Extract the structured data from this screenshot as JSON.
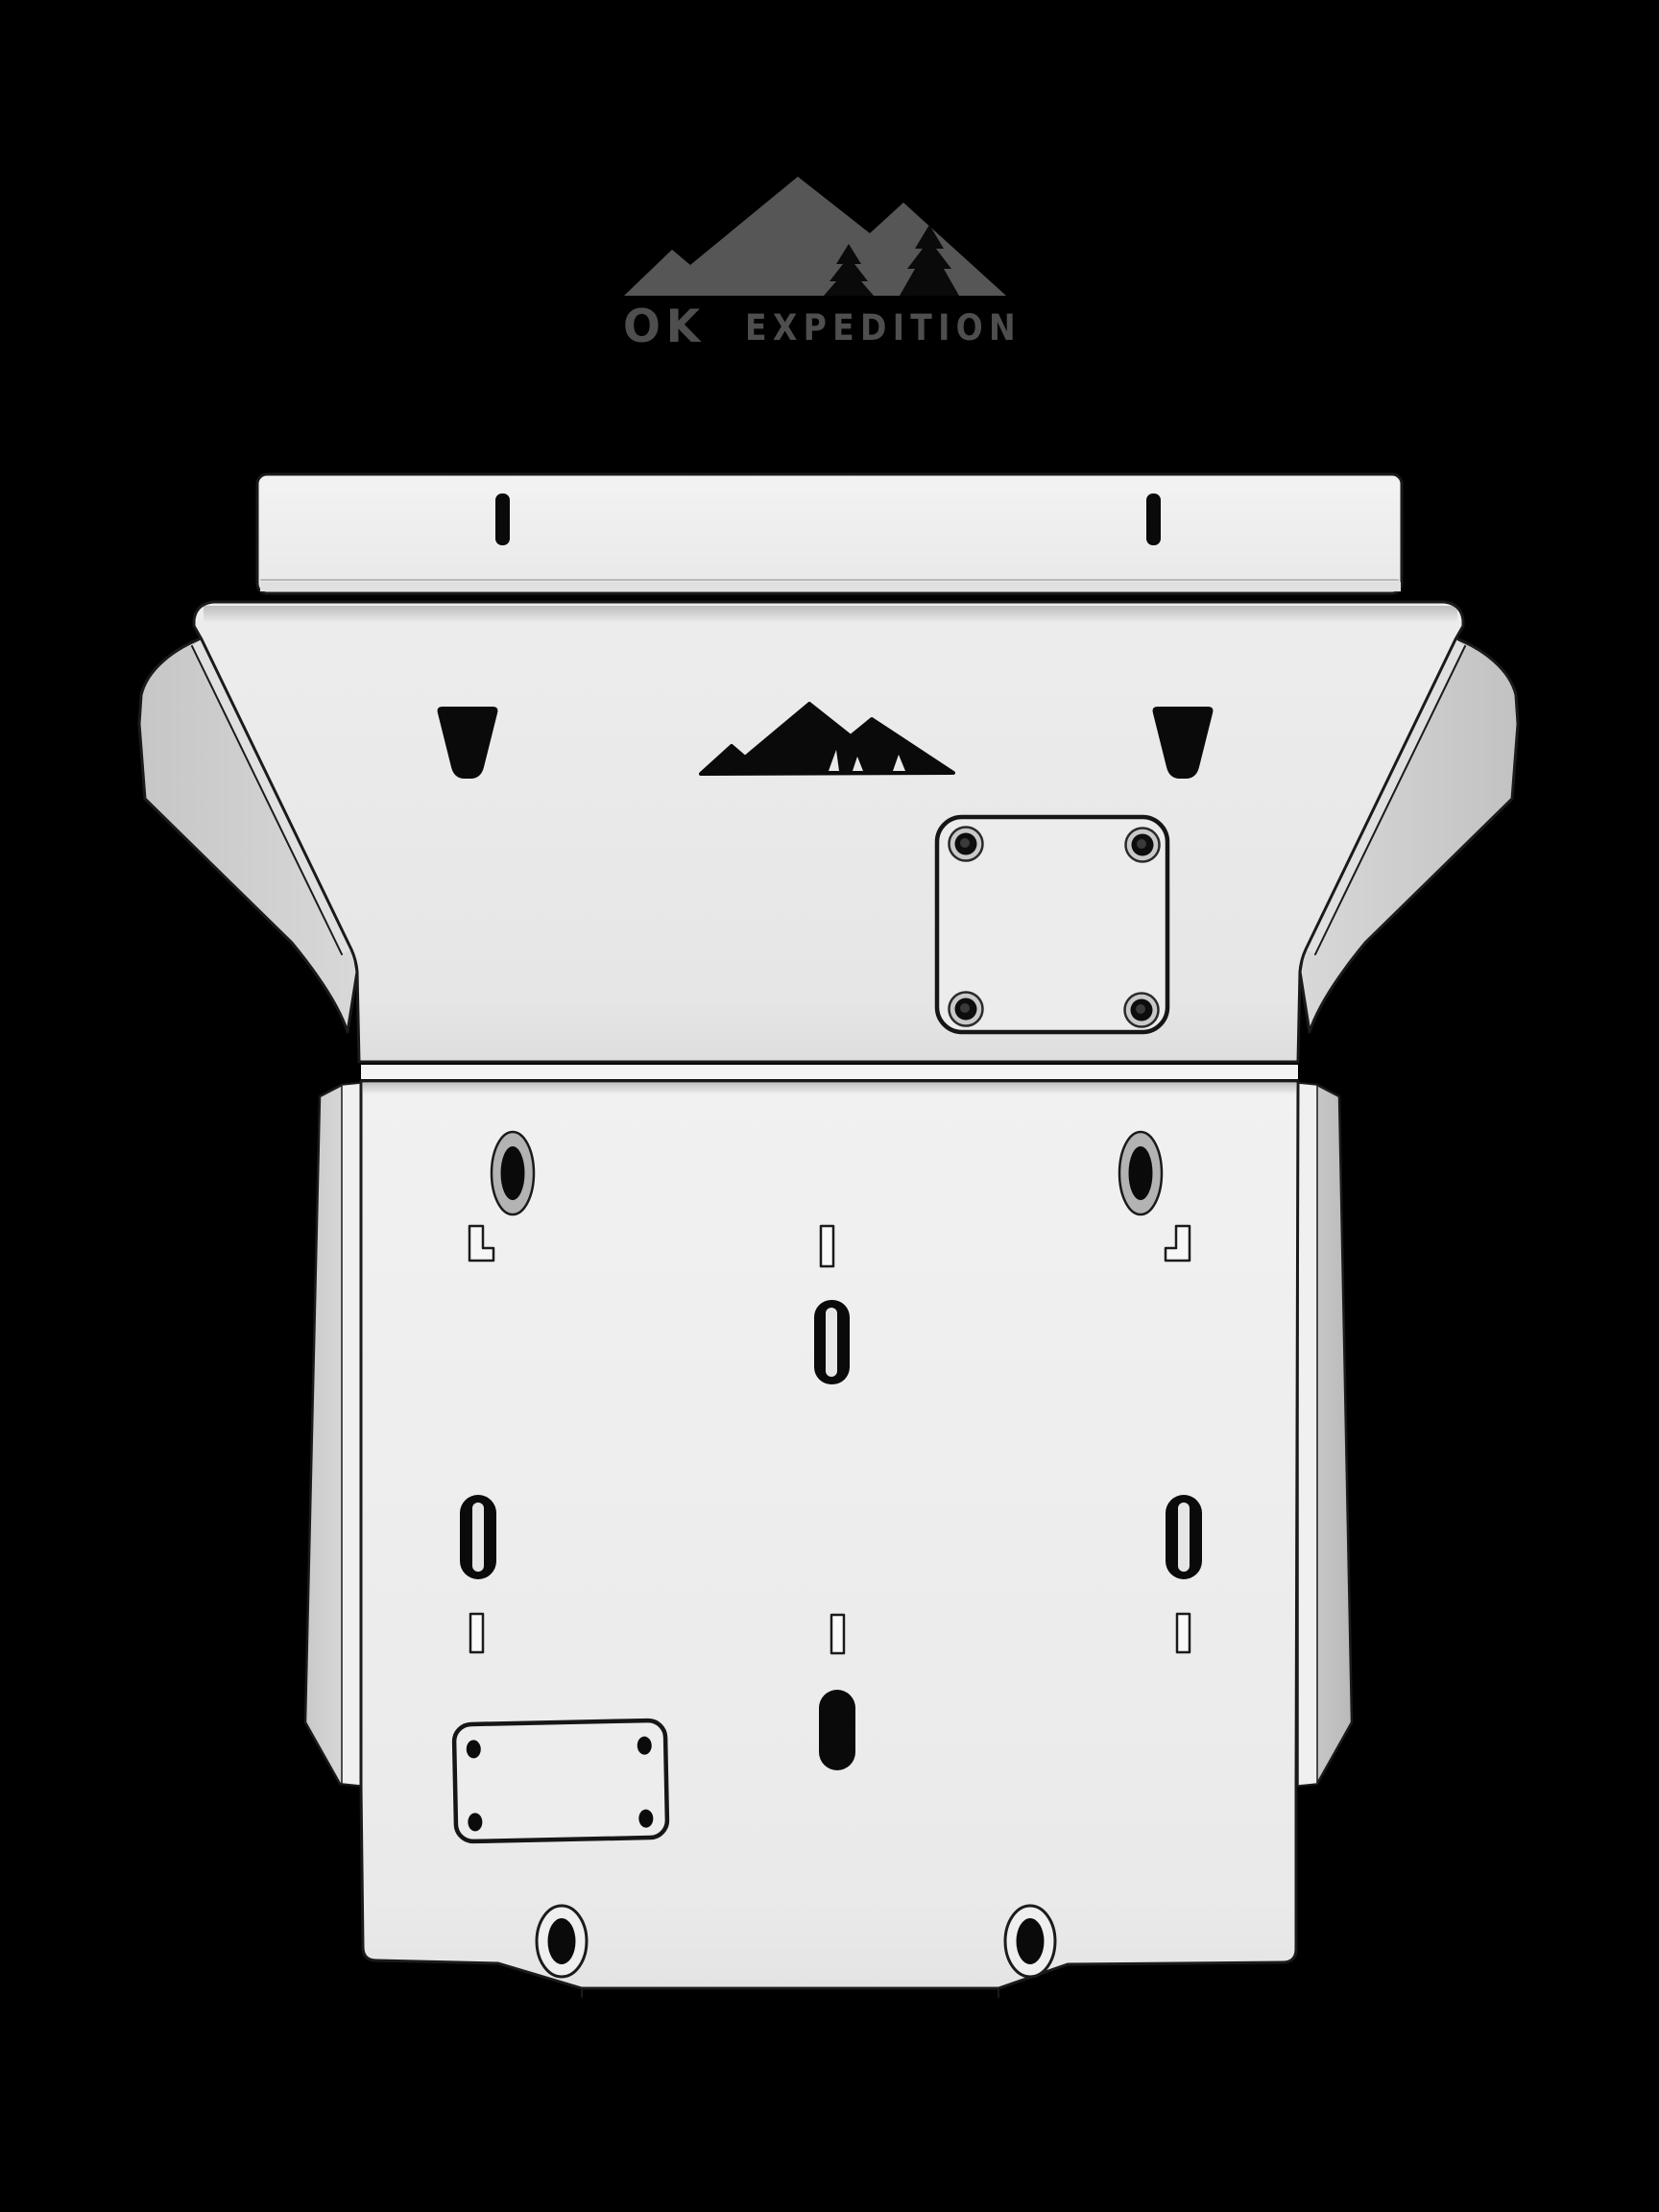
{
  "background_color": "#000000",
  "logo": {
    "brand_primary": "OK",
    "brand_secondary": "EXPEDITION",
    "mountain_icon": "mountain-range-with-pine-trees-icon",
    "mountain_color": "#565656",
    "tree_color": "#0a0a0a",
    "text_color": "#4e4e4e"
  },
  "plate": {
    "material_color": "#ececec",
    "wing_color": "#c9c9c9",
    "outline_color": "#1a1a1a",
    "cutout_color": "#0a0a0a",
    "emblem_cutout_icon": "mountain-silhouette-cutout",
    "features": {
      "top_mount_slots": 2,
      "trapezoid_cutouts": 2,
      "square_access_panel_bolts": 4,
      "rect_access_panel_bolts": 4,
      "counterbored_oval_slots_upper": 2,
      "counterbored_oval_slots_lower": 2,
      "open_oval_slots": 3,
      "solid_oval_slot": 1,
      "small_slits": 4,
      "l_shaped_slots": 2
    }
  }
}
